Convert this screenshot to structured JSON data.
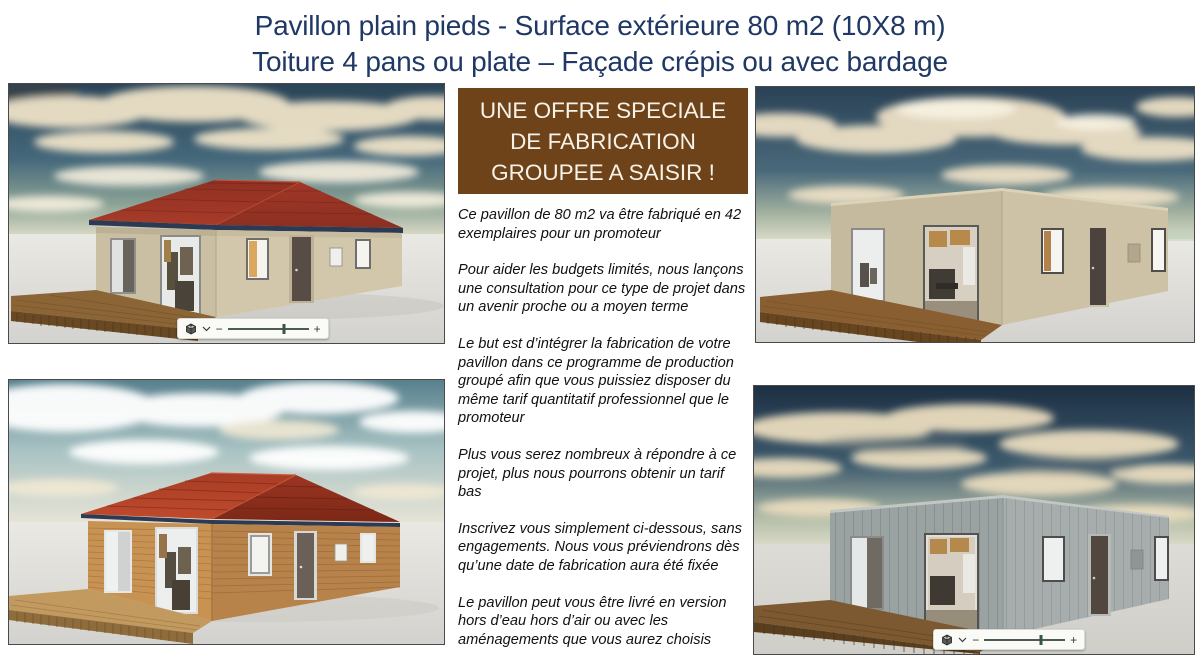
{
  "title": {
    "line1": "Pavillon plain pieds  - Surface extérieure 80 m2 (10X8 m)",
    "line2": "Toiture 4 pans ou plate – Façade crépis ou avec bardage"
  },
  "offer": {
    "banner": {
      "line1": "UNE OFFRE SPECIALE",
      "line2": "DE FABRICATION",
      "line3": "GROUPEE A SAISIR !"
    },
    "paragraphs": [
      "Ce pavillon de 80 m2 va être fabriqué en 42 exemplaires pour un promoteur",
      "Pour aider les budgets limités, nous lançons une consultation pour ce type de projet dans un avenir proche ou a moyen terme",
      "Le but est d’intégrer la fabrication de votre pavillon dans ce programme de production groupé afin que vous puissiez disposer du même tarif quantitatif professionnel que le promoteur",
      "Plus vous serez nombreux à répondre à ce projet, plus nous pourrons obtenir un tarif  bas",
      "Inscrivez vous simplement ci-dessous, sans engagements. Nous vous préviendrons dès qu’une date de fabrication aura été fixée",
      "Le pavillon  peut vous être livré en version hors d’eau hors d’air ou avec les aménagements que vous aurez choisis"
    ]
  },
  "renders": [
    {
      "position": "top-left",
      "description": "Pavillon façade crépis beige, toiture 4 pans rouge, terrasse bois",
      "toolbar_visible": true
    },
    {
      "position": "top-right",
      "description": "Pavillon façade crépis beige, toiture plate, terrasse bois",
      "toolbar_visible": false
    },
    {
      "position": "bottom-left",
      "description": "Pavillon bardage bois, toiture 4 pans rouge, terrasse bois",
      "toolbar_visible": false
    },
    {
      "position": "bottom-right",
      "description": "Pavillon bardage gris, toiture plate, terrasse bois",
      "toolbar_visible": true
    }
  ],
  "viewer_toolbar": {
    "zoom_out": "−",
    "zoom_in": "+",
    "slider_percent": 70,
    "icons": {
      "cube": "3d-view-cube",
      "chevron": "chevron-down"
    }
  },
  "colors": {
    "title": "#1f3864",
    "banner-bg": "#6f431a",
    "banner-text": "#f7f2e8",
    "body-text": "#111111",
    "panel-border": "#4a4a4a"
  }
}
